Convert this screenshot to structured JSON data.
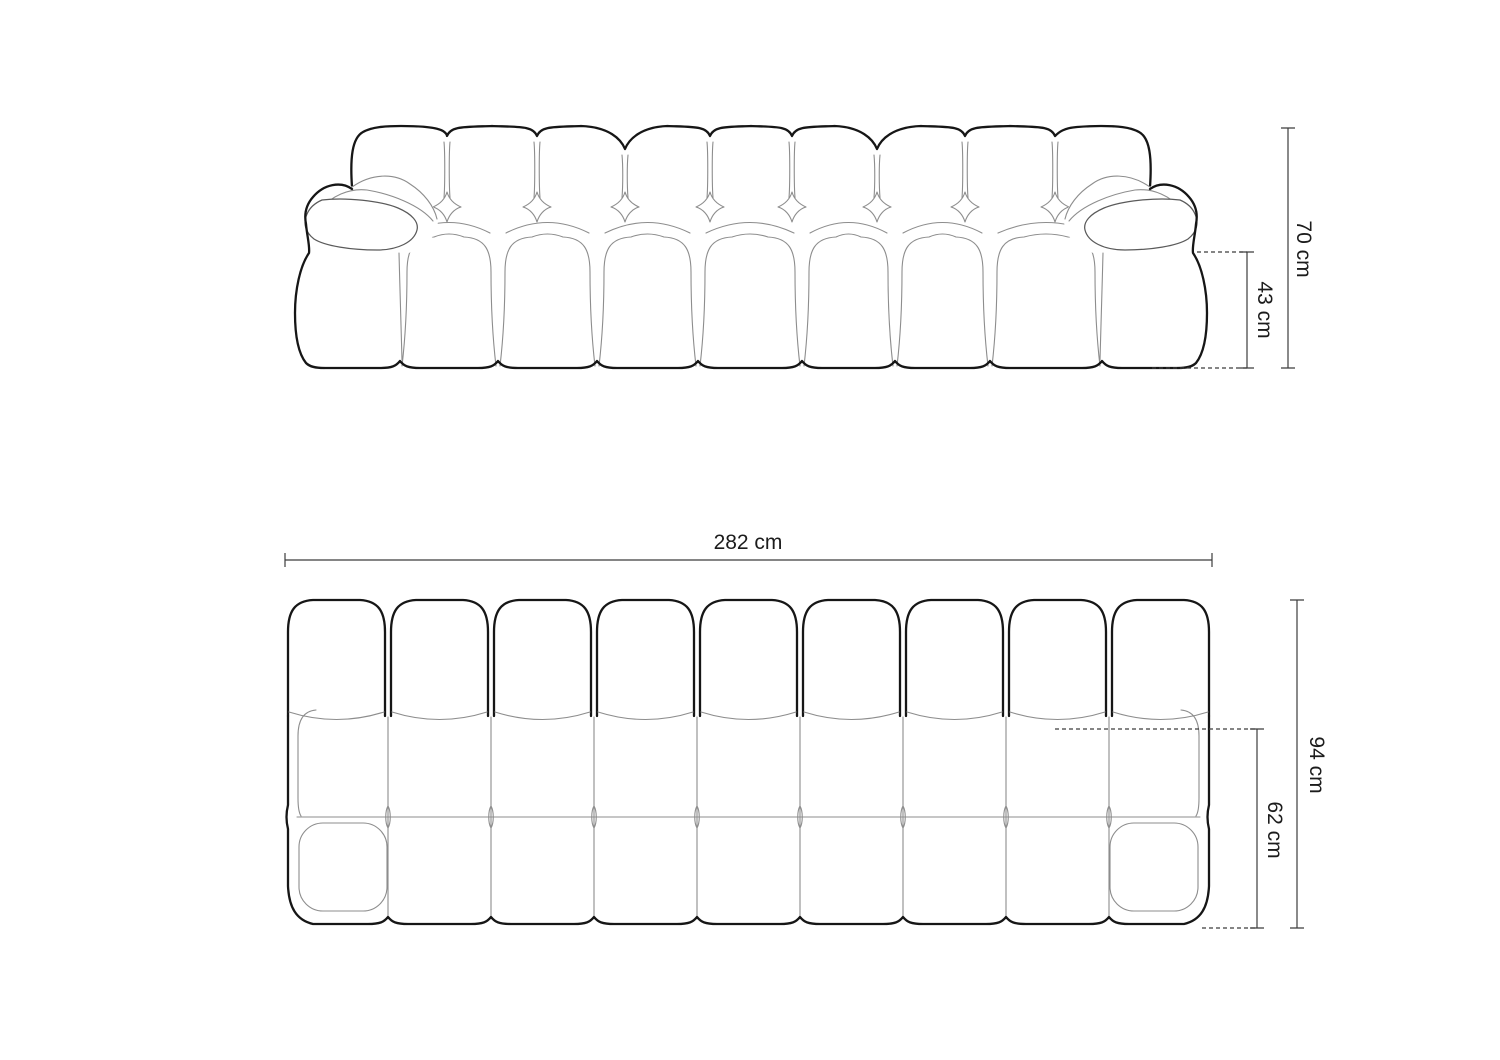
{
  "diagram": {
    "type": "furniture-dimension-drawing",
    "views": {
      "front": "sofa-front-elevation",
      "top": "sofa-top-plan"
    },
    "front_view": {
      "height_label": "70 cm",
      "seat_height_label": "43 cm"
    },
    "top_view": {
      "width_label": "282 cm",
      "depth_label": "94 cm",
      "seat_depth_label": "62 cm"
    }
  },
  "colors": {
    "background": "#ffffff",
    "outline": "#161616",
    "contour": "#8d8d8d",
    "mid_contour": "#5a5a5a",
    "dimension_line": "#3c3c3c",
    "label_text": "#1c1c1c"
  }
}
